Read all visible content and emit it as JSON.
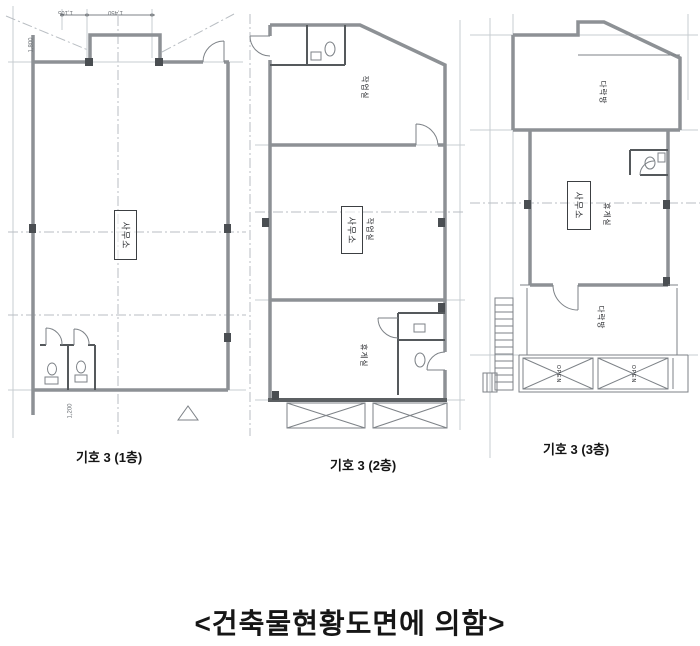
{
  "page": {
    "footer_caption": "<건축물현황도면에 의함>"
  },
  "plans": {
    "p1": {
      "caption": "기호 3 (1층)",
      "room_office": "사무소",
      "dim_top_left": "1,105",
      "dim_top_right": "1,450",
      "dim_left": "1,800",
      "dim_bottom": "1,200"
    },
    "p2": {
      "caption": "기호 3 (2층)",
      "room_top": "작업실",
      "room_office": "사무소",
      "room_office_note": "작업실",
      "room_bottom": "휴게실"
    },
    "p3": {
      "caption": "기호 3 (3층)",
      "room_top": "다락방",
      "room_office": "사무소",
      "room_office_note": "휴게실",
      "room_bottom": "다락방",
      "open_label_1": "OPEN",
      "open_label_2": "OPEN"
    }
  }
}
